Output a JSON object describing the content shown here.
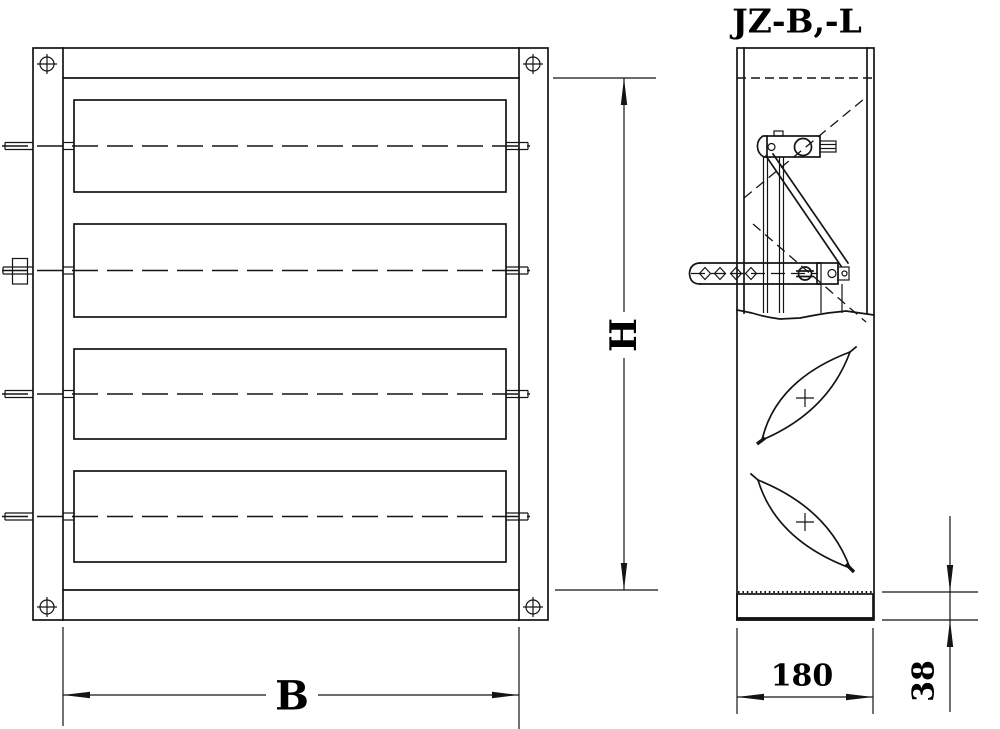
{
  "drawing": {
    "title": "JZ-B,-L",
    "type_note_colors": {
      "line": "#141414",
      "background": "#ffffff"
    }
  },
  "views": {
    "front": {
      "blade_count": 4,
      "corner_screw_count": 4
    },
    "side": {
      "blade_sections": 2,
      "has_linkage": true
    }
  },
  "dimensions": {
    "height": "H",
    "width": "B",
    "depth": "180",
    "bottom_frame": "38"
  }
}
